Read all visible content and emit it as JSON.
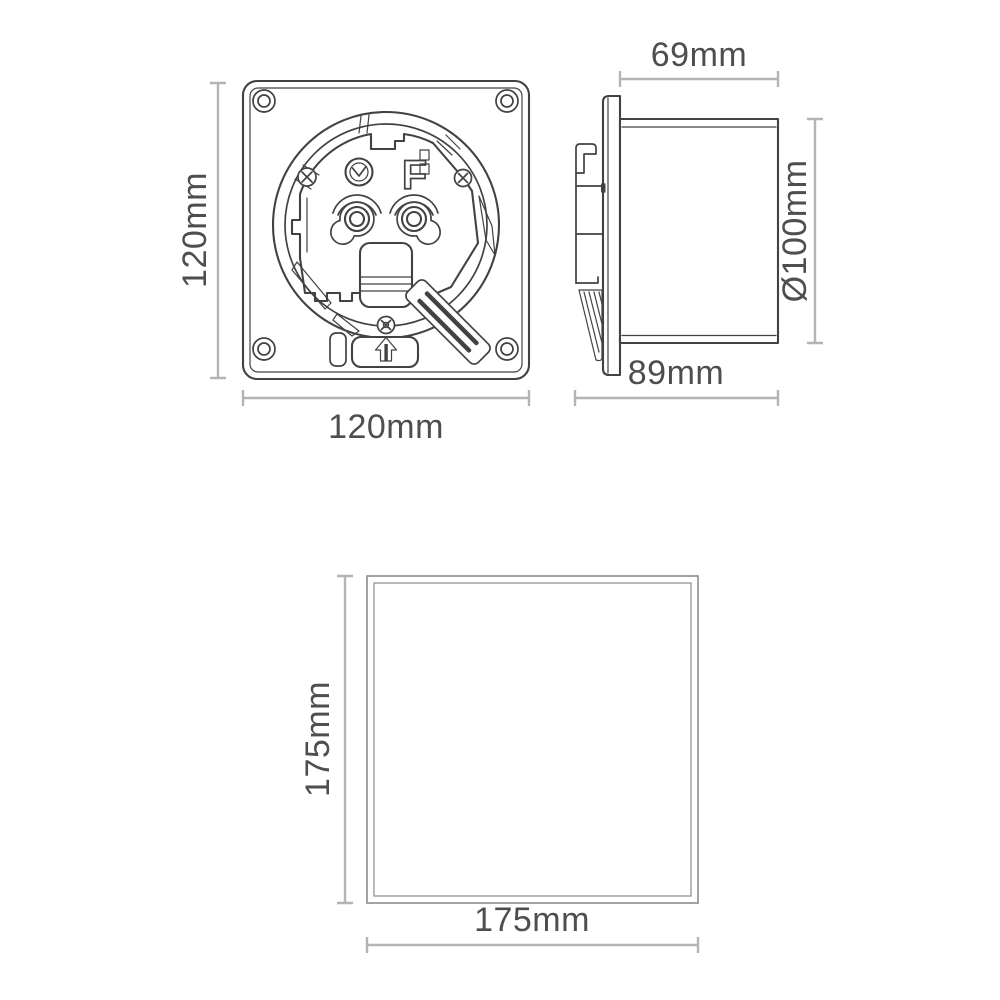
{
  "diagram": {
    "views": {
      "front": {
        "width_label": "120mm",
        "height_label": "120mm",
        "marking_letter": "F"
      },
      "side": {
        "depth_label": "69mm",
        "diameter_label": "Ø100mm",
        "body_depth_label": "89mm"
      },
      "cover": {
        "width_label": "175mm",
        "height_label": "175mm"
      }
    },
    "colors": {
      "drawing_line": "#414244",
      "cover_line": "#8c8c8c",
      "dimension_line": "#b4b4b4",
      "dimension_text": "#4d4e50",
      "background": "#ffffff"
    }
  }
}
